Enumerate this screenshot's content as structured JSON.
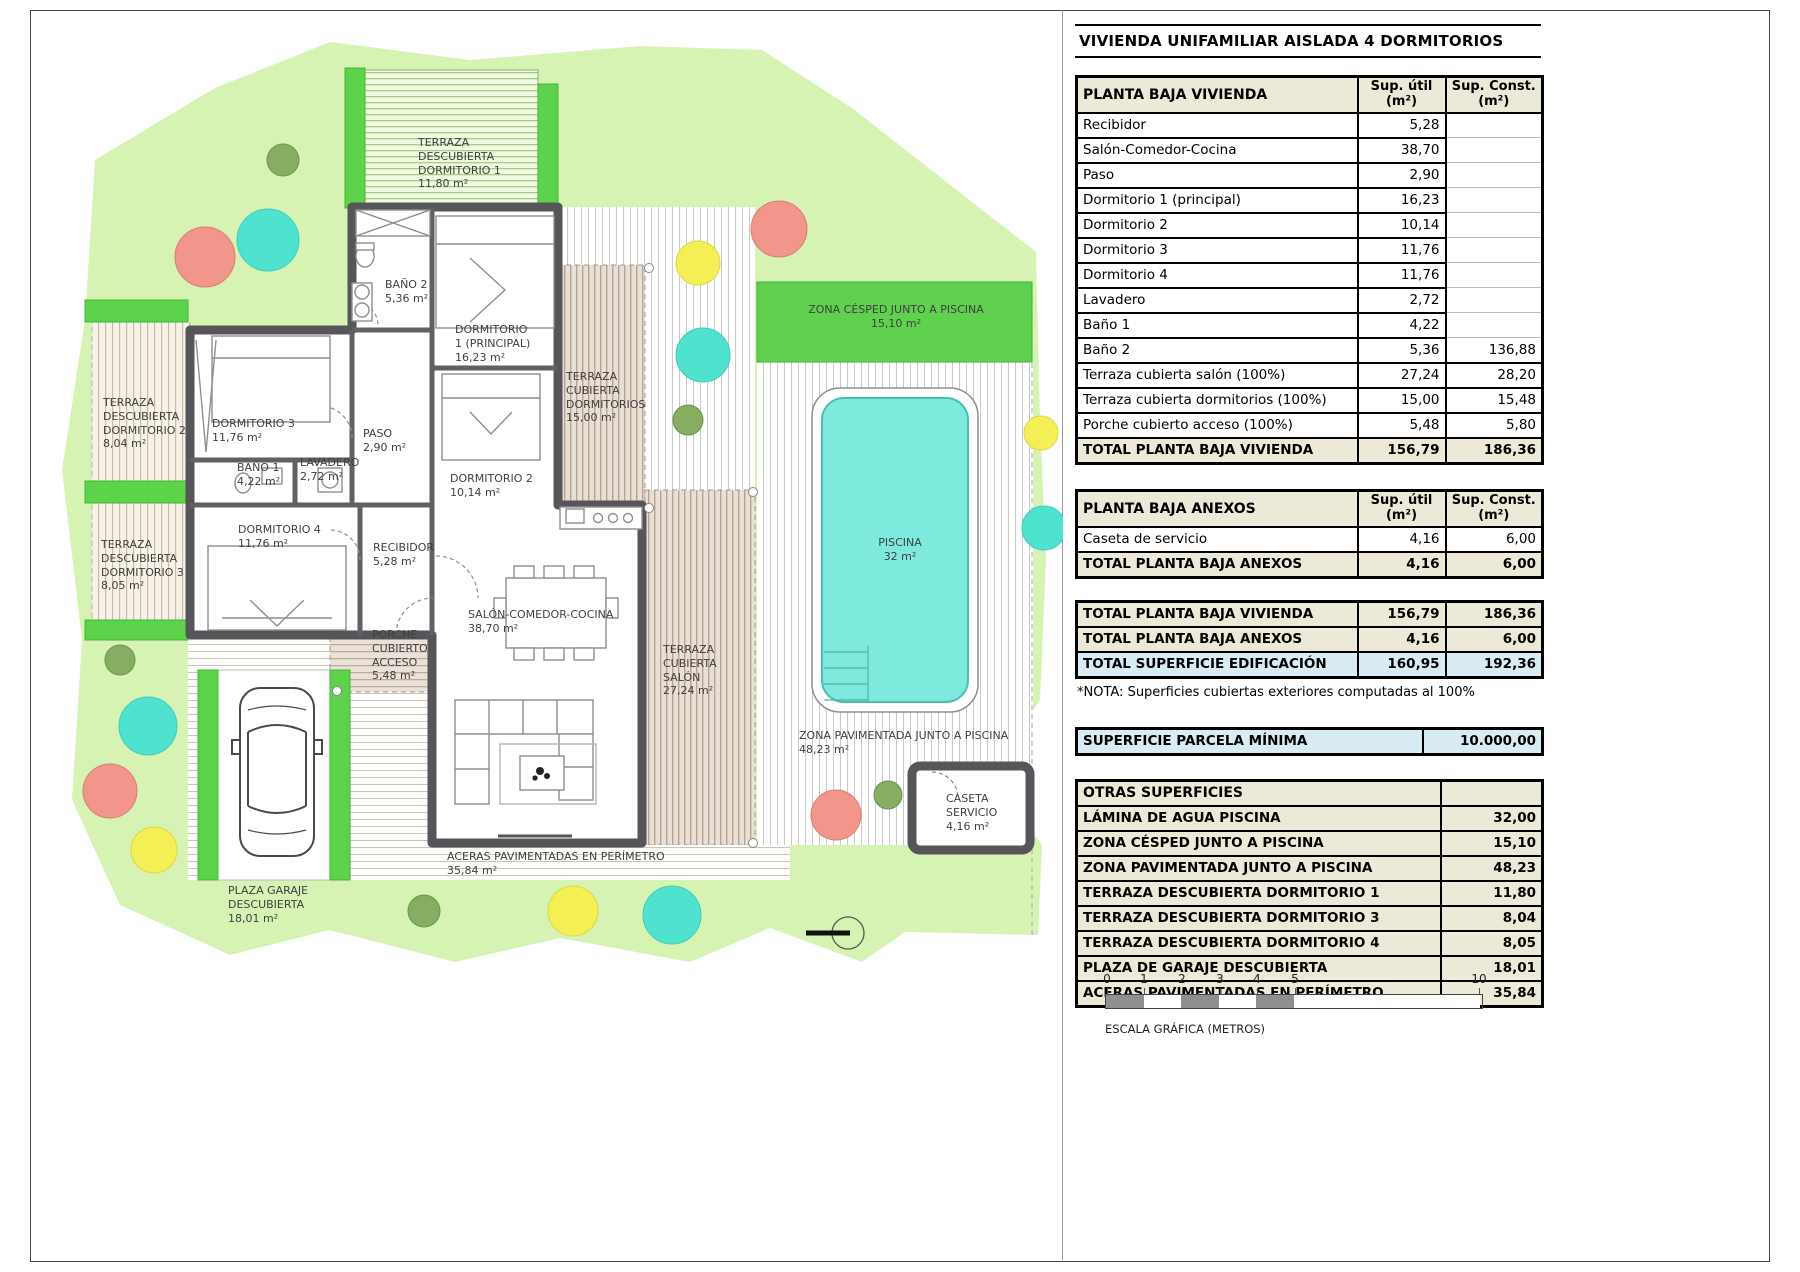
{
  "title": "VIVIENDA UNIFAMILIAR AISLADA 4 DORMITORIOS",
  "tables": {
    "vivienda": {
      "title": "PLANTA BAJA VIVIENDA",
      "col_util": "Sup. útil",
      "col_const": "Sup. Const.",
      "unit": "(m²)",
      "rows": [
        [
          "Recibidor",
          "5,28",
          ""
        ],
        [
          "Salón-Comedor-Cocina",
          "38,70",
          ""
        ],
        [
          "Paso",
          "2,90",
          ""
        ],
        [
          "Dormitorio 1 (principal)",
          "16,23",
          ""
        ],
        [
          "Dormitorio 2",
          "10,14",
          ""
        ],
        [
          "Dormitorio 3",
          "11,76",
          ""
        ],
        [
          "Dormitorio 4",
          "11,76",
          ""
        ],
        [
          "Lavadero",
          "2,72",
          ""
        ],
        [
          "Baño 1",
          "4,22",
          ""
        ],
        [
          "Baño 2",
          "5,36",
          "136,88"
        ],
        [
          "Terraza cubierta salón (100%)",
          "27,24",
          "28,20"
        ],
        [
          "Terraza cubierta dormitorios (100%)",
          "15,00",
          "15,48"
        ],
        [
          "Porche cubierto acceso (100%)",
          "5,48",
          "5,80"
        ]
      ],
      "total": [
        "TOTAL PLANTA BAJA VIVIENDA",
        "156,79",
        "186,36"
      ]
    },
    "anexos": {
      "title": "PLANTA BAJA ANEXOS",
      "col_util": "Sup. útil",
      "col_const": "Sup. Const.",
      "unit": "(m²)",
      "rows": [
        [
          "Caseta de servicio",
          "4,16",
          "6,00"
        ]
      ],
      "total": [
        "TOTAL PLANTA BAJA ANEXOS",
        "4,16",
        "6,00"
      ]
    },
    "summary": {
      "rows": [
        [
          "TOTAL PLANTA BAJA VIVIENDA",
          "156,79",
          "186,36"
        ],
        [
          "TOTAL PLANTA BAJA ANEXOS",
          "4,16",
          "6,00"
        ],
        [
          "TOTAL SUPERFICIE EDIFICACIÓN",
          "160,95",
          "192,36"
        ]
      ]
    },
    "note": "*NOTA: Superficies cubiertas exteriores computadas al 100%",
    "parcela": {
      "label": "SUPERFICIE PARCELA MÍNIMA",
      "value": "10.000,00"
    },
    "otras": {
      "title": "OTRAS SUPERFICIES",
      "rows": [
        [
          "LÁMINA DE AGUA PISCINA",
          "32,00"
        ],
        [
          "ZONA CÉSPED JUNTO A PISCINA",
          "15,10"
        ],
        [
          "ZONA PAVIMENTADA JUNTO A PISCINA",
          "48,23"
        ],
        [
          "TERRAZA DESCUBIERTA DORMITORIO 1",
          "11,80"
        ],
        [
          "TERRAZA DESCUBIERTA DORMITORIO 3",
          "8,04"
        ],
        [
          "TERRAZA DESCUBIERTA DORMITORIO 4",
          "8,05"
        ],
        [
          "PLAZA DE GARAJE DESCUBIERTA",
          "18,01"
        ],
        [
          "ACERAS PAVIMENTADAS EN PERÍMETRO",
          "35,84"
        ]
      ]
    }
  },
  "scalebar": {
    "ticks": [
      "0",
      "1",
      "2",
      "3",
      "4",
      "5",
      "10"
    ],
    "caption": "ESCALA GRÁFICA (METROS)"
  },
  "plan": {
    "labels": {
      "terraza_dorm1": {
        "lines": [
          "TERRAZA",
          "DESCUBIERTA",
          "DORMITORIO 1",
          "11,80 m²"
        ]
      },
      "bano2": {
        "lines": [
          "BAÑO 2",
          "5,36 m²"
        ]
      },
      "dorm1": {
        "lines": [
          "DORMITORIO",
          "1 (PRINCIPAL)",
          "16,23 m²"
        ]
      },
      "terraza_cub_dorm": {
        "lines": [
          "TERRAZA",
          "CUBIERTA",
          "DORMITORIOS",
          "15,00 m²"
        ]
      },
      "dorm3": {
        "lines": [
          "DORMITORIO 3",
          "11,76 m²"
        ]
      },
      "paso": {
        "lines": [
          "PASO",
          "2,90 m²"
        ]
      },
      "bano1": {
        "lines": [
          "BAÑO 1",
          "4,22 m²"
        ]
      },
      "lavadero": {
        "lines": [
          "LAVADERO",
          "2,72 m²"
        ]
      },
      "dorm2": {
        "lines": [
          "DORMITORIO 2",
          "10,14 m²"
        ]
      },
      "dorm4": {
        "lines": [
          "DORMITORIO 4",
          "11,76 m²"
        ]
      },
      "recibidor": {
        "lines": [
          "RECIBIDOR",
          "5,28 m²"
        ]
      },
      "terraza_dorm2": {
        "lines": [
          "TERRAZA",
          "DESCUBIERTA",
          "DORMITORIO 2",
          "8,04 m²"
        ]
      },
      "terraza_dorm3": {
        "lines": [
          "TERRAZA",
          "DESCUBIERTA",
          "DORMITORIO 3",
          "8,05 m²"
        ]
      },
      "salon": {
        "lines": [
          "SALÓN-COMEDOR-COCINA",
          "38,70 m²"
        ]
      },
      "porche": {
        "lines": [
          "PORCHE",
          "CUBIERTO",
          "ACCESO",
          "5,48 m²"
        ]
      },
      "terraza_cub_salon": {
        "lines": [
          "TERRAZA",
          "CUBIERTA",
          "SALÓN",
          "27,24 m²"
        ]
      },
      "aceras": {
        "lines": [
          "ACERAS PAVIMENTADAS EN PERÍMETRO",
          "35,84 m²"
        ]
      },
      "plaza_garaje": {
        "lines": [
          "PLAZA GARAJE",
          "DESCUBIERTA",
          "18,01 m²"
        ]
      },
      "zona_cesped": {
        "lines": [
          "ZONA CÉSPED JUNTO A PISCINA",
          "15,10 m²"
        ]
      },
      "piscina": {
        "lines": [
          "PISCINA",
          "32 m²"
        ]
      },
      "zona_pavimentada": {
        "lines": [
          "ZONA PAVIMENTADA JUNTO A PISCINA",
          "48,23 m²"
        ]
      },
      "caseta": {
        "lines": [
          "CASETA",
          "SERVICIO",
          "4,16 m²"
        ]
      }
    }
  }
}
